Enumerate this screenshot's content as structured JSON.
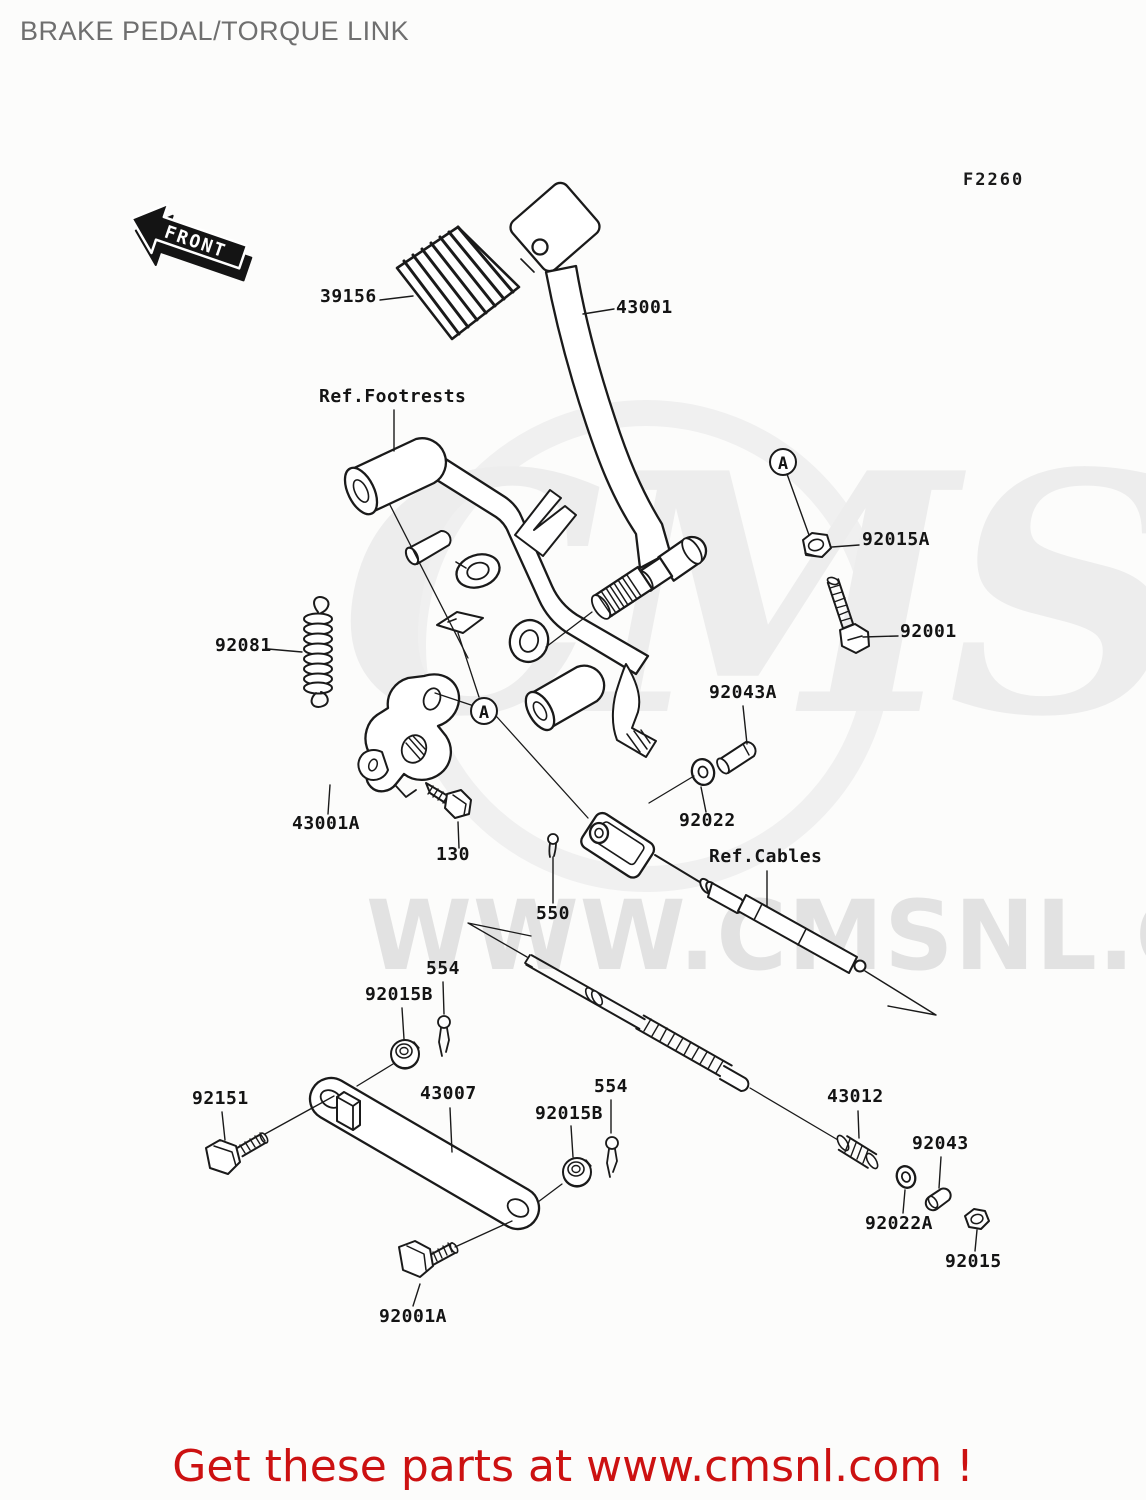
{
  "page": {
    "title": "BRAKE PEDAL/TORQUE LINK",
    "figure_code": "F2260",
    "footer_text": "Get these parts at www.cmsnl.com !",
    "accent_color": "#cc1111"
  },
  "watermark": {
    "logo_text": "CMS",
    "url_text": "WWW.CMSNL.COM"
  },
  "diagram": {
    "front_label": "FRONT",
    "detail_marker": "A",
    "callouts": [
      {
        "label": "39156"
      },
      {
        "label": "43001"
      },
      {
        "label": "Ref.Footrests"
      },
      {
        "label": "92015A"
      },
      {
        "label": "92001"
      },
      {
        "label": "92081"
      },
      {
        "label": "92043A"
      },
      {
        "label": "43001A"
      },
      {
        "label": "130"
      },
      {
        "label": "92022"
      },
      {
        "label": "Ref.Cables"
      },
      {
        "label": "550"
      },
      {
        "label": "554"
      },
      {
        "label": "92015B"
      },
      {
        "label": "92151"
      },
      {
        "label": "43007"
      },
      {
        "label": "554"
      },
      {
        "label": "92015B"
      },
      {
        "label": "43012"
      },
      {
        "label": "92043"
      },
      {
        "label": "92022A"
      },
      {
        "label": "92015"
      },
      {
        "label": "92001A"
      }
    ]
  }
}
